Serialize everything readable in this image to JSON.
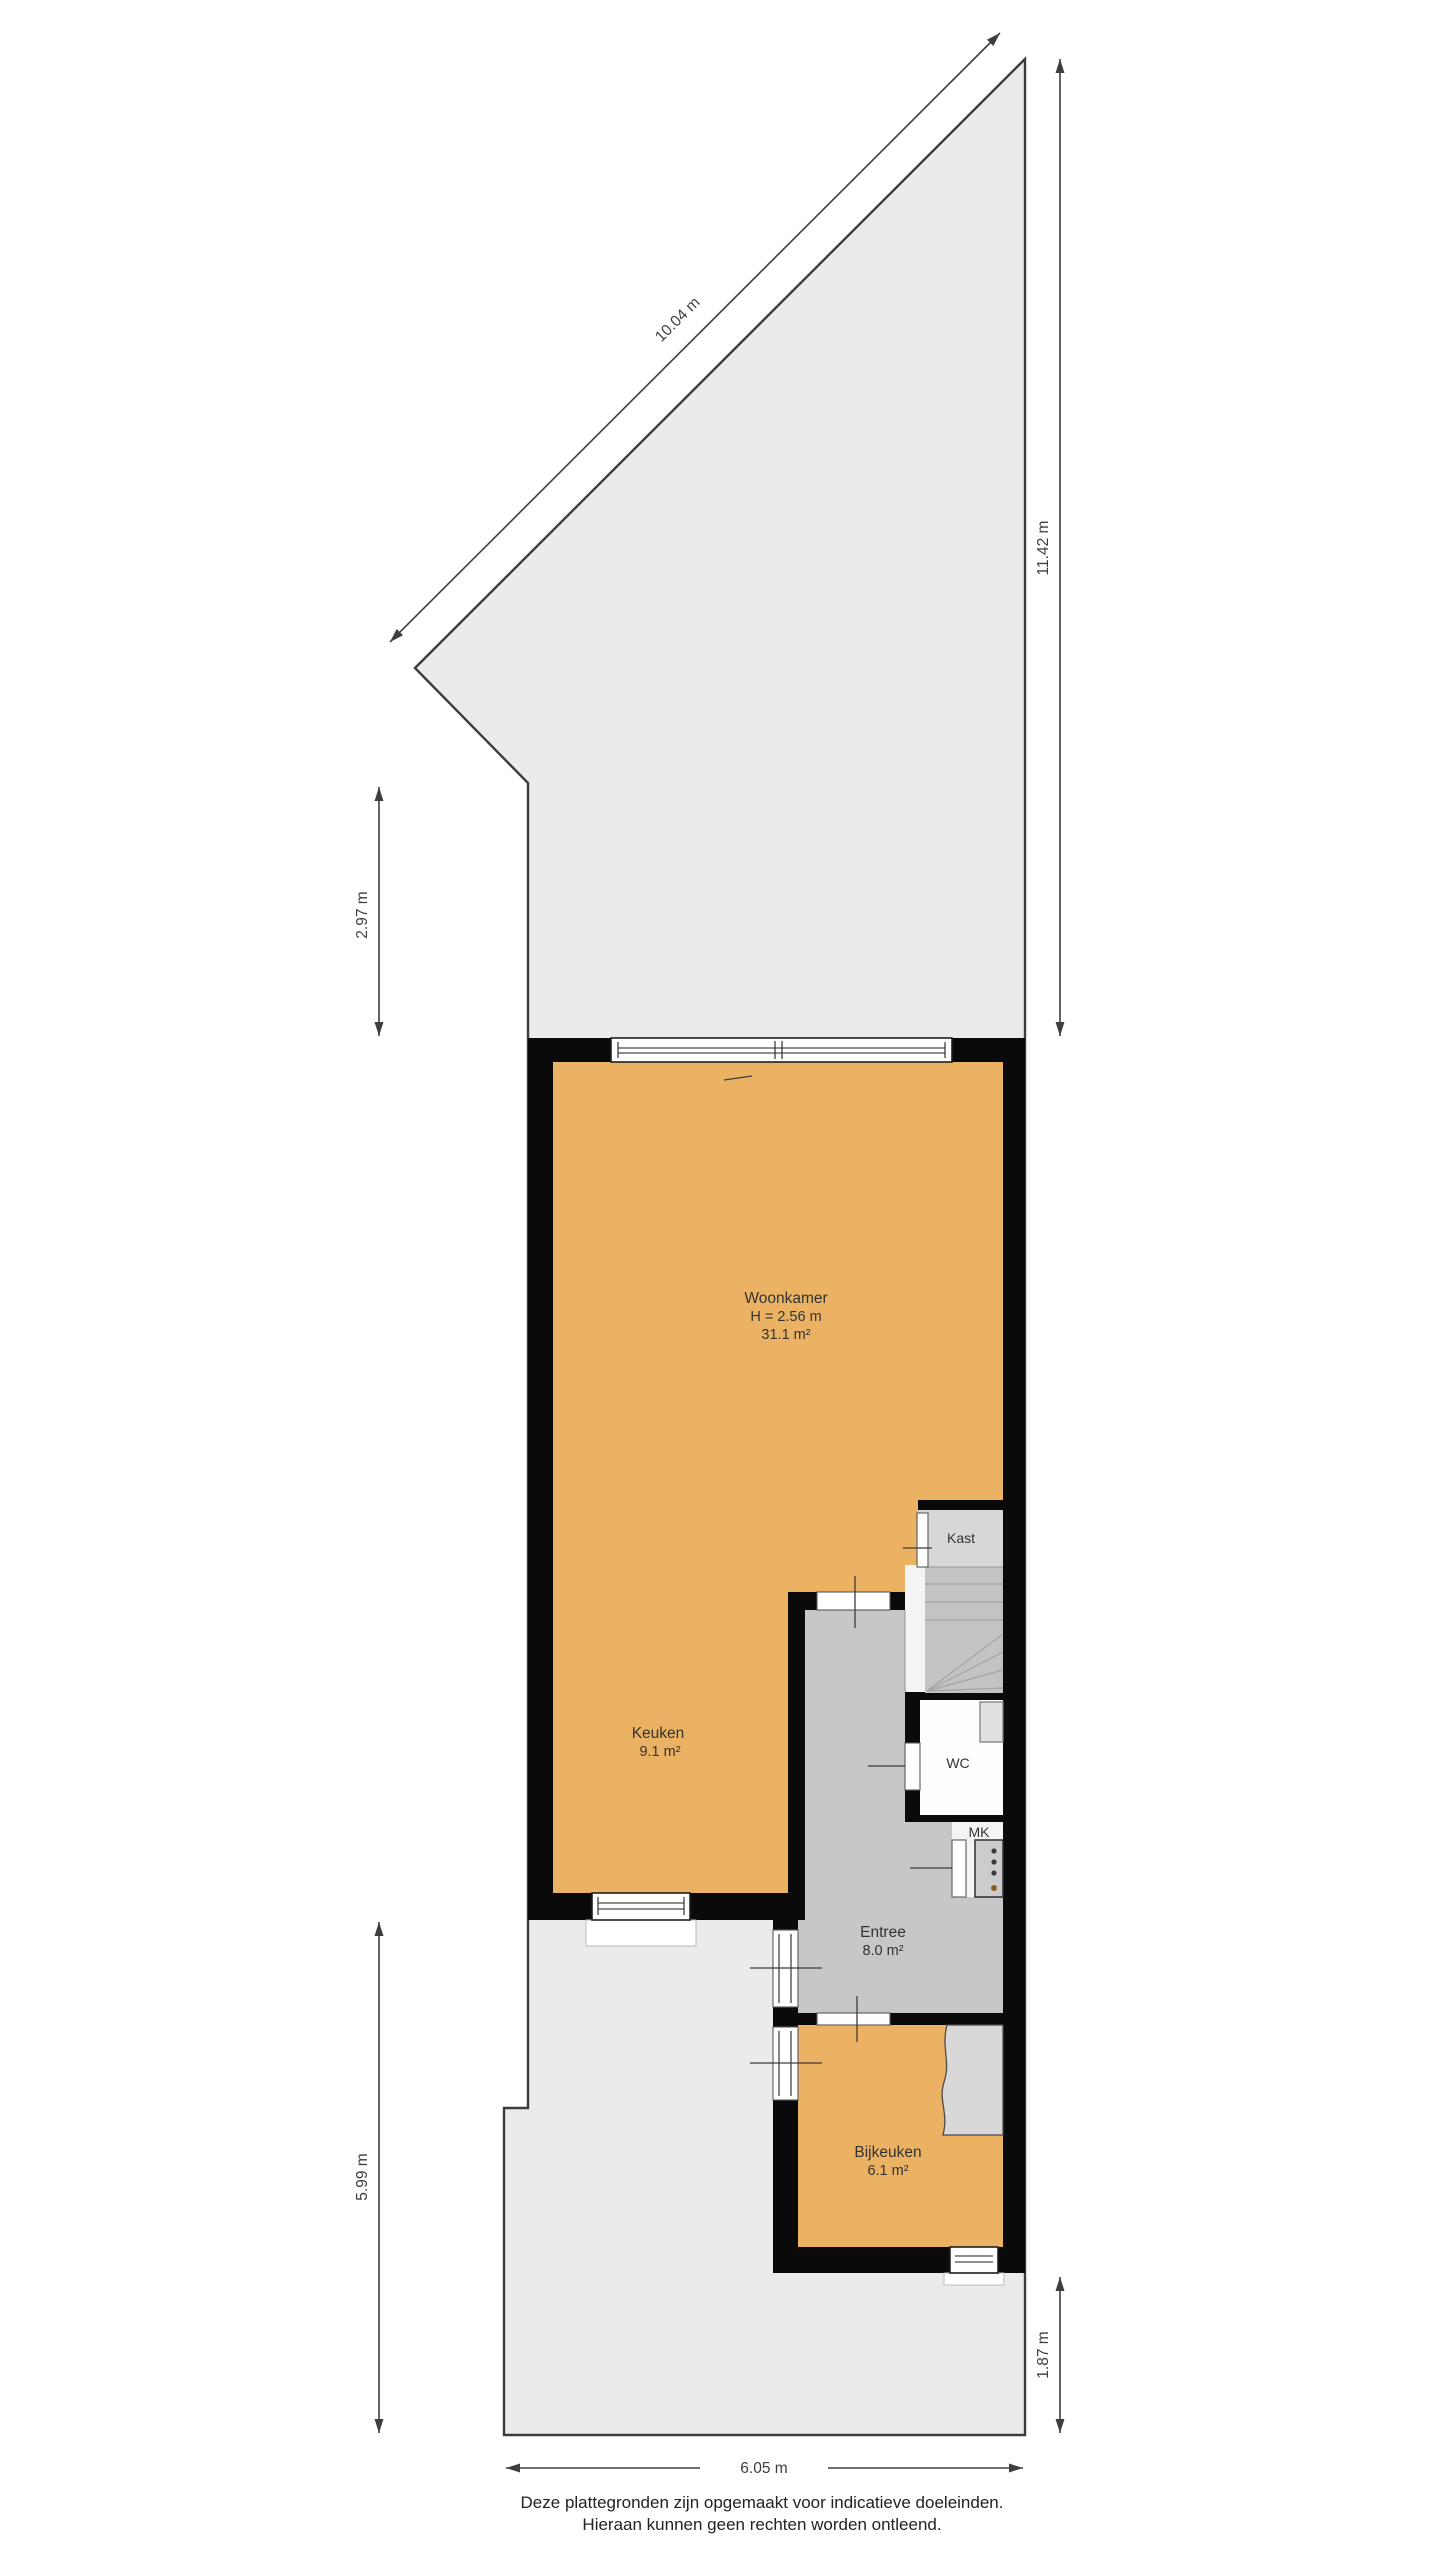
{
  "plan_title": "Begane grond plattegrond",
  "rooms": {
    "woonkamer": {
      "label": "Woonkamer",
      "height": "H = 2.56 m",
      "area": "31.1 m²"
    },
    "keuken": {
      "label": "Keuken",
      "area": "9.1 m²"
    },
    "kast": {
      "label": "Kast"
    },
    "wc": {
      "label": "WC"
    },
    "mk": {
      "label": "MK"
    },
    "entree": {
      "label": "Entree",
      "area": "8.0 m²"
    },
    "bijkeuken": {
      "label": "Bijkeuken",
      "area": "6.1 m²"
    }
  },
  "dimensions": {
    "plot_top_diagonal": "10.04 m",
    "plot_right": "11.42 m",
    "plot_left_upper": "2.97 m",
    "plot_left_lower": "5.99 m",
    "plot_bottom_right": "1.87 m",
    "plot_bottom": "6.05 m"
  },
  "footer": {
    "line1": "Deze plattegronden zijn opgemaakt voor indicatieve doeleinden.",
    "line2": "Hieraan kunnen geen rechten worden ontleend."
  },
  "colors": {
    "lot": "#ebebeb",
    "outline": "#3c3c3c",
    "wall": "#0a0a0a",
    "floor_orange": "#eab262",
    "entree": "#c7c7c7",
    "kast": "#d7d7d7",
    "stairs": "#c3c3c3",
    "stairs_line": "#a3a3a3",
    "landing": "#f4f4f4",
    "wc": "#fdfdfd",
    "fixture": "#e0e0e0",
    "counter": "#d8d8d8",
    "appliance": "#cccccc",
    "window": "#ffffff",
    "window_stroke": "#1f1f1f",
    "dim": "#3e3e3e",
    "text": "#333333"
  }
}
